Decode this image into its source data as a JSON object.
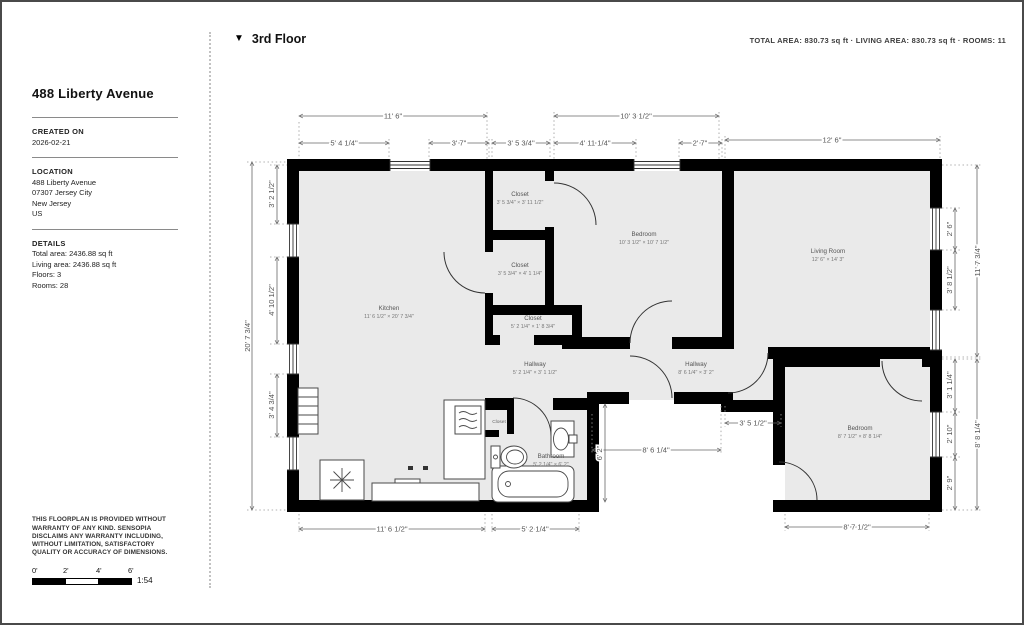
{
  "sidebar": {
    "title": "488 Liberty Avenue",
    "created": {
      "label": "CREATED ON",
      "value": "2026-02-21"
    },
    "location": {
      "label": "LOCATION",
      "lines": [
        "488 Liberty Avenue",
        "07307 Jersey City",
        "New Jersey",
        "US"
      ]
    },
    "details": {
      "label": "DETAILS",
      "lines": [
        "Total area: 2436.88 sq ft",
        "Living area: 2436.88 sq ft",
        "Floors: 3",
        "Rooms: 28"
      ]
    },
    "disclaimer": "THIS FLOORPLAN IS PROVIDED WITHOUT WARRANTY OF ANY KIND. SENSOPIA DISCLAIMS ANY WARRANTY INCLUDING, WITHOUT LIMITATION, SATISFACTORY QUALITY OR ACCURACY OF DIMENSIONS.",
    "scale": {
      "ticks": [
        "0'",
        "2'",
        "4'",
        "6'"
      ],
      "ratio": "1:54"
    }
  },
  "header": {
    "floor": "3rd Floor",
    "stats": "TOTAL AREA:  830.73 sq ft · LIVING AREA:  830.73 sq ft · ROOMS: 11"
  },
  "plan": {
    "rooms": [
      {
        "name": "Kitchen",
        "dims": "11' 6 1/2\" × 20' 7 3/4\""
      },
      {
        "name": "Closet",
        "dims": "3' 5 3/4\" × 3' 11 1/2\""
      },
      {
        "name": "Closet",
        "dims": "3' 5 3/4\" × 4' 1 1/4\""
      },
      {
        "name": "Closet",
        "dims": "5' 2 1/4\" × 1' 8 3/4\""
      },
      {
        "name": "Hallway",
        "dims": "5' 2 1/4\" × 3' 1 1/2\""
      },
      {
        "name": "Bedroom",
        "dims": "10' 3 1/2\" × 10' 7 1/2\""
      },
      {
        "name": "Living Room",
        "dims": "12' 6\" × 14' 3\""
      },
      {
        "name": "Hallway",
        "dims": "8' 6 1/4\" × 3' 2\""
      },
      {
        "name": "Bathroom",
        "dims": "5' 2 1/4\" × 6' 2\""
      },
      {
        "name": "Bedroom",
        "dims": "8' 7 1/2\" × 8' 8 1/4\""
      },
      {
        "name": "Closet",
        "dims": ""
      }
    ],
    "dims": [
      "11' 6\"",
      "10' 3 1/2\"",
      "12' 6\"",
      "5' 4 1/4\"",
      "3' 7\"",
      "3' 5 3/4\"",
      "4' 11 1/4\"",
      "2' 7\"",
      "20' 7 3/4\"",
      "3' 2 1/2\"",
      "4' 10 1/2\"",
      "3' 4 3/4\"",
      "11' 7 3/4\"",
      "2' 6\"",
      "3' 8 1/2\"",
      "8' 8 1/4\"",
      "3' 1 1/4\"",
      "2' 10\"",
      "2' 9\"",
      "11' 6 1/2\"",
      "5' 2 1/4\"",
      "8' 7 1/2\"",
      "8' 6 1/4\"",
      "6' 2\"",
      "3' 5 1/2\""
    ]
  }
}
